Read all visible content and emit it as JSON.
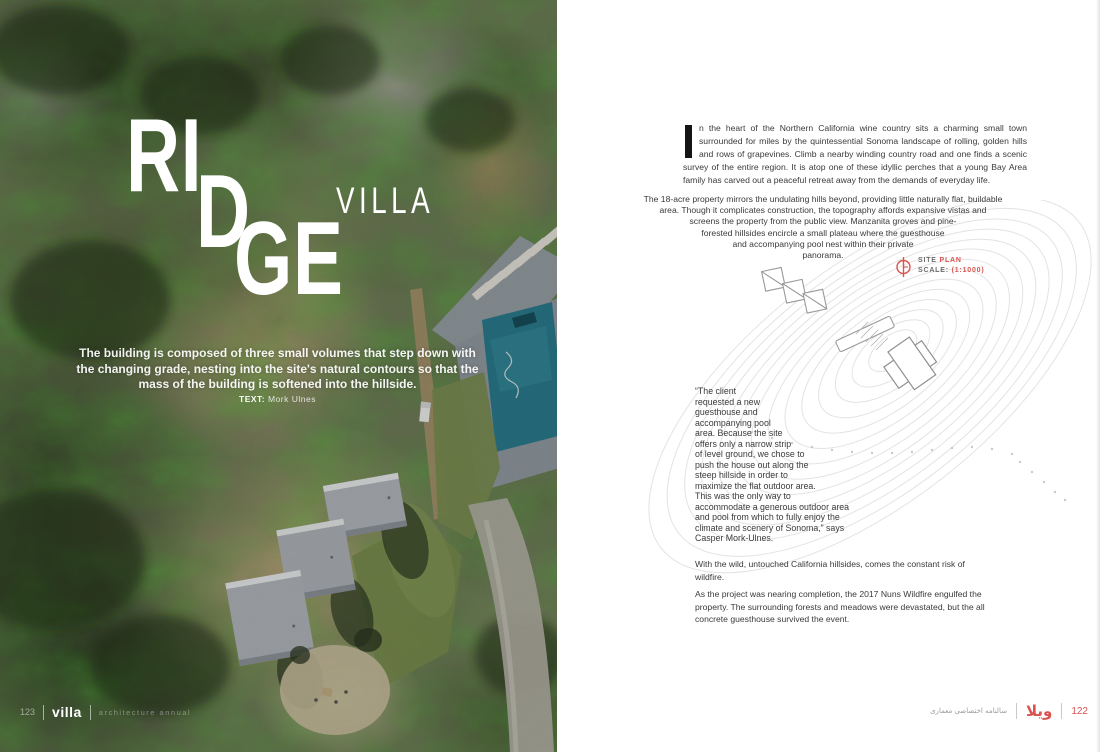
{
  "left_page": {
    "title": {
      "line1": "RI",
      "line2": "D",
      "line3": "GE",
      "subtitle": "VILLA"
    },
    "standfirst": "The building is composed of three small volumes that step down with the changing grade, nesting into the site's natural contours so that the mass of the building is softened into the hillside.",
    "byline_label": "TEXT:",
    "byline_value": "Mork Ulnes",
    "footer": {
      "page_number": "123",
      "magazine": "villa",
      "tagline": "architecture annual"
    }
  },
  "right_page": {
    "article": {
      "drop_cap": "I",
      "p1": "n the heart of the Northern California wine country sits a charming small town surrounded for miles by the quintessential Sonoma landscape of rolling, golden hills and rows of grapevines. Climb a nearby winding country road and one finds a scenic survey of the entire region. It is atop one of these idyllic perches that a young Bay Area family has carved out a peaceful retreat away from the demands of everyday life.",
      "p2": "The 18-acre property mirrors the undulating hills beyond, providing little naturally flat, buildable area. Though it complicates construction, the topography affords expansive vistas and screens the property from the public view. Manzanita groves and pine-forested hillsides encircle a small plateau where the guesthouse and accompanying pool nest within their private panorama.",
      "quote": "“The client requested a new guesthouse and accompanying pool area. Because the site offers only a narrow strip of level ground, we chose to push the house out along the steep hillside in order to maximize the flat outdoor area. This was the only way to accommodate a generous outdoor area and pool from which to fully enjoy the climate and scenery of Sonoma,” says Casper Mork-Ulnes.",
      "p3": "With the wild, untouched California hillsides, comes the constant risk of wildfire.",
      "p4": "As the project was nearing completion, the 2017 Nuns Wildfire engulfed the property. The surrounding forests and meadows were devastated, but the all concrete guesthouse survived the event."
    },
    "site_plan": {
      "label_site": "SITE",
      "label_plan": "PLAN",
      "scale_label": "SCALE:",
      "scale_value": "(1:1000)"
    },
    "footer": {
      "annual_fa": "سالنامه اختصاصی معماری",
      "logo_fa": "ویلا",
      "page_number": "122"
    }
  },
  "colors": {
    "accent_red": "#d9534f",
    "body_text": "#3a3a3a",
    "contour_gray": "#e3e3e3"
  }
}
